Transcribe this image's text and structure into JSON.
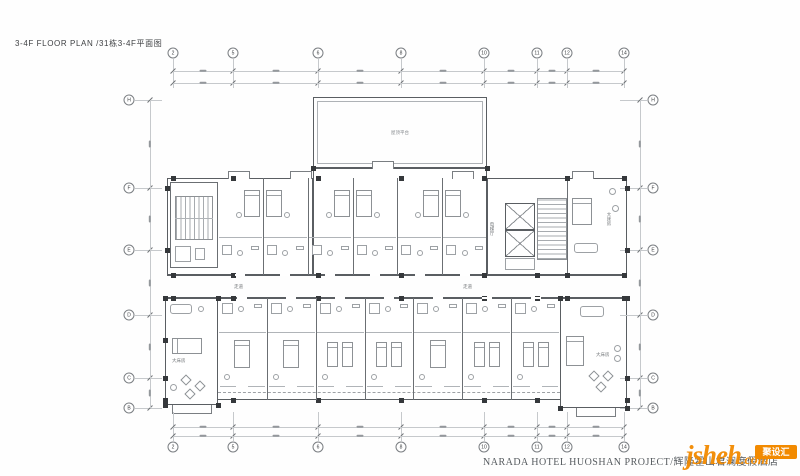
{
  "title": "3-4F FLOOR PLAN /31栋3-4F平面图",
  "grid": {
    "top": [
      "2",
      "5",
      "6",
      "8",
      "10",
      "11",
      "12",
      "14"
    ],
    "bottom": [
      "2",
      "5",
      "6",
      "8",
      "10",
      "11",
      "12",
      "14"
    ],
    "left": [
      "H",
      "F",
      "E",
      "D",
      "C",
      "B"
    ],
    "right": [
      "H",
      "F",
      "E",
      "D",
      "C",
      "B"
    ]
  },
  "plan": {
    "roof_terrace": "屋顶平台",
    "corridor_left": "走道",
    "corridor_right": "走道",
    "elevator_hall": "电梯厅",
    "king_room_upper_right": "大床房",
    "king_room_lower_left": "大床房",
    "king_room_lower_right": "大床房"
  },
  "footer": {
    "project": "NARADA HOTEL HUOSHAN PROJECT/辉隆霍山君澜度假酒店"
  },
  "logo": {
    "name": "jsheh",
    "tld": ".com",
    "badge": "聚设汇",
    "color": "#f28a00"
  }
}
